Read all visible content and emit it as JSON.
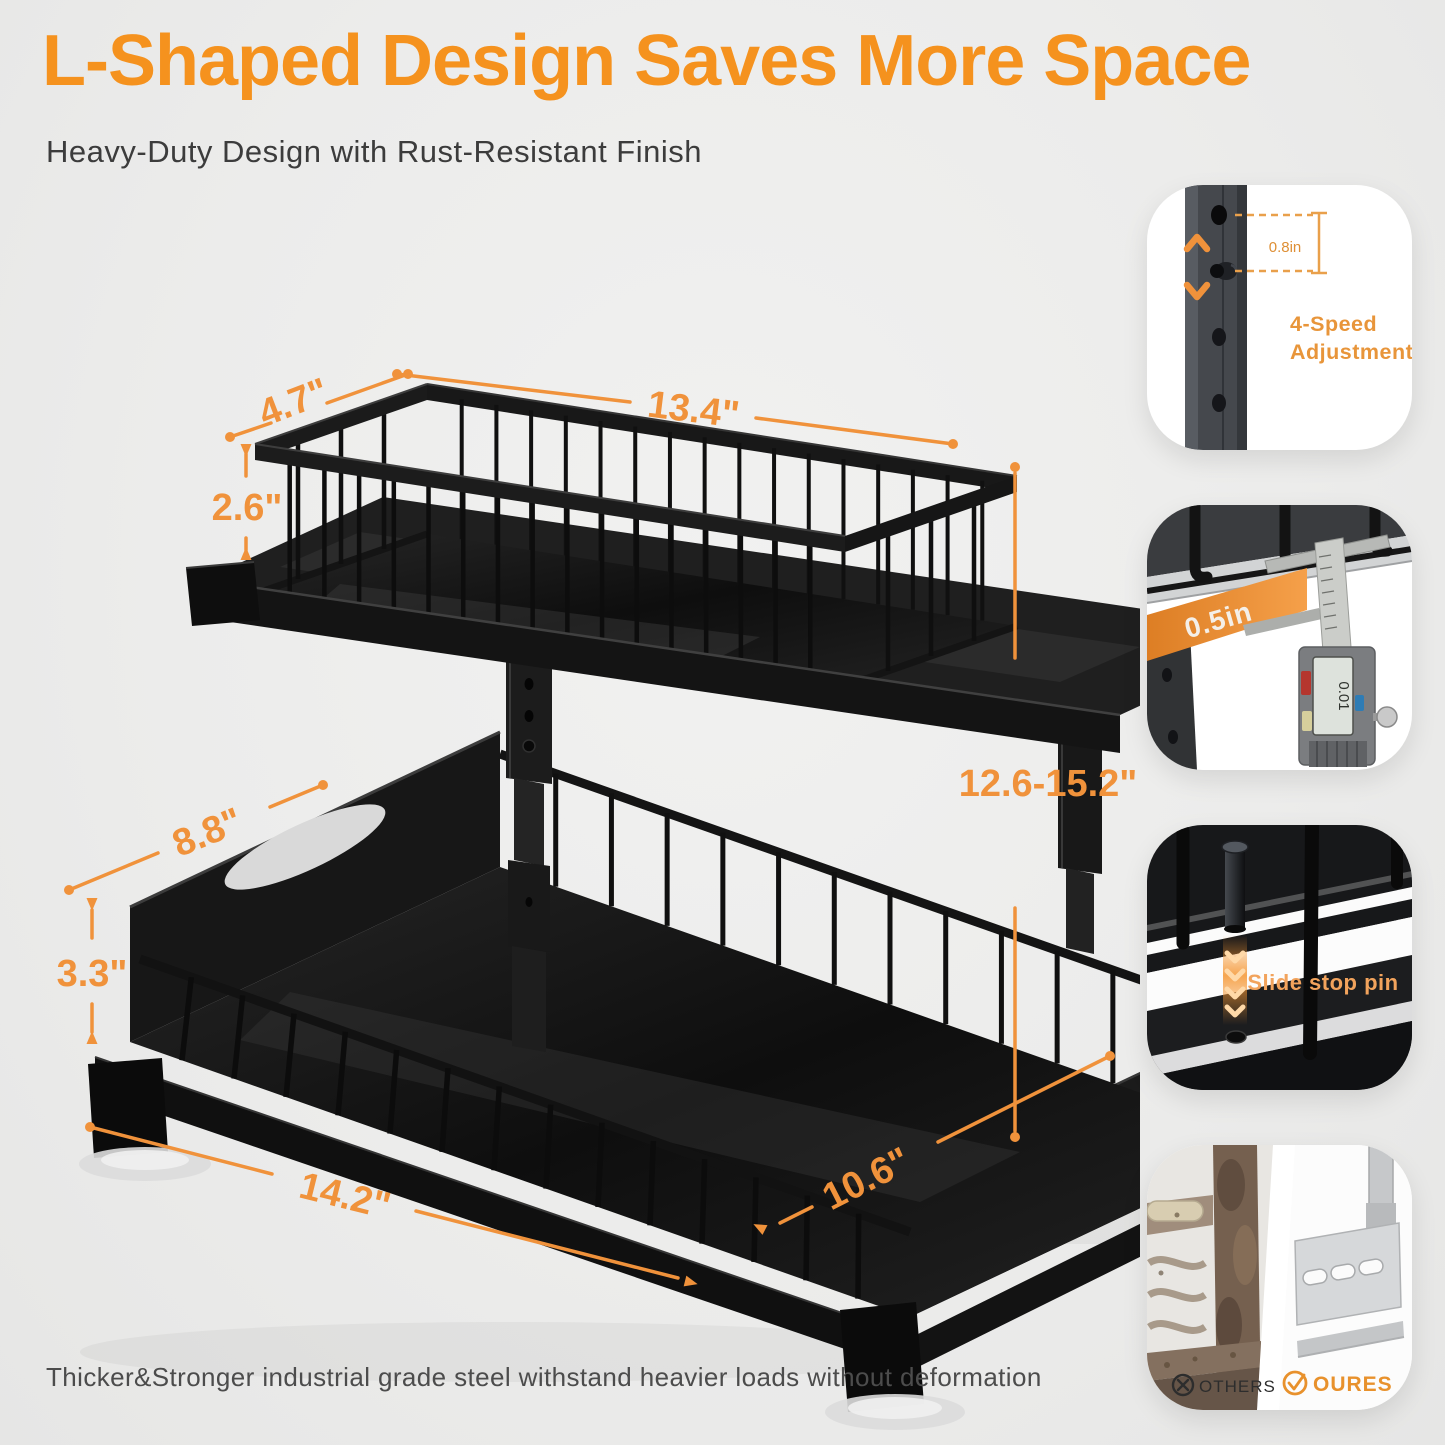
{
  "header": {
    "title": "L-Shaped Design Saves More Space",
    "subtitle": "Heavy-Duty Design with Rust-Resistant Finish"
  },
  "diagram": {
    "dims": {
      "top_depth": "4.7\"",
      "top_length": "13.4\"",
      "top_height": "2.6\"",
      "drawer_depth": "8.8\"",
      "drawer_height": "3.3\"",
      "base_length": "14.2\"",
      "base_depth": "10.6\"",
      "overall_height": "12.6-15.2\""
    }
  },
  "features": [
    {
      "measure": "0.8in",
      "label_line1": "4-Speed",
      "label_line2": "Adjustment"
    },
    {
      "measure": "0.5in"
    },
    {
      "label": "Slide stop pin"
    },
    {
      "others": "OTHERS",
      "ours": "OURES"
    }
  ],
  "footer": {
    "caption": "Thicker&Stronger industrial grade steel withstand heavier loads without deformation"
  },
  "colors": {
    "accent": "#F5921E",
    "dim_line": "#F0923B"
  }
}
